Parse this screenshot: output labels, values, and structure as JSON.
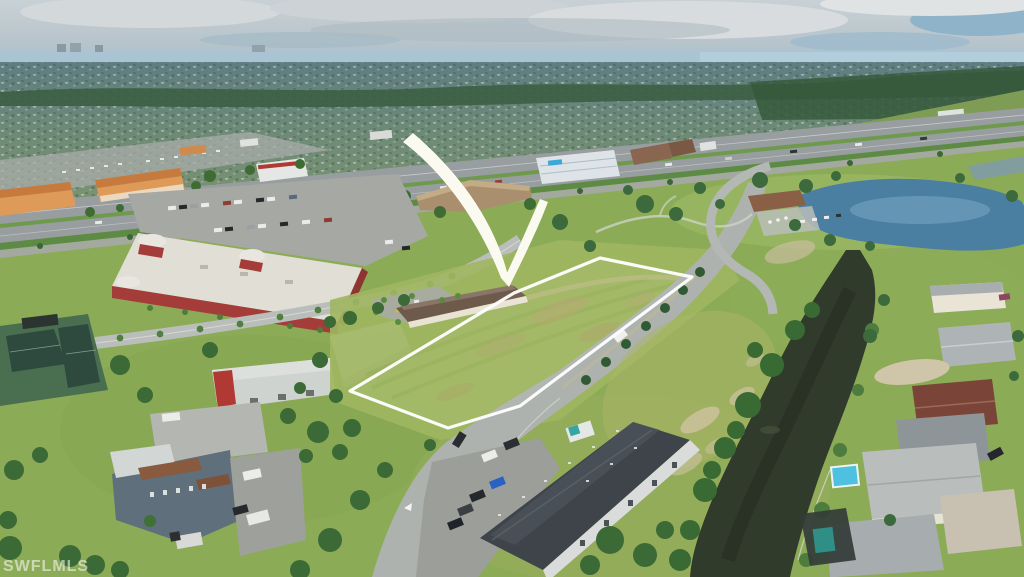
{
  "scene": {
    "type": "aerial-drone-photograph",
    "subject": "vacant commercial corner lot highlighted with a white boundary outline and a white curved arrow",
    "watermark": "SWFLMLS"
  },
  "annotations": {
    "boundary_color": "#ffffff",
    "arrow_color": "#fbfaf0",
    "watermark_color": "rgba(255,255,255,0.55)"
  },
  "palette": {
    "sky": "#c3ccd1",
    "horizon_water": "#a9c4d4",
    "suburb": "#6e8a7c",
    "tree_line": "#3d5f43",
    "grass": "#8cab57",
    "lot_grass": "#a0b660",
    "highway": "#989da0",
    "road": "#aeb2ae",
    "canal": "#313b2b",
    "pond": "#4b7fa2",
    "red_building_wall": "#a43d39",
    "red_building_roof": "#e0ded5",
    "plaza_orange": "#dd9a58",
    "dark_roof": "#3e4449",
    "warehouse_roof": "#cfd3d0"
  }
}
